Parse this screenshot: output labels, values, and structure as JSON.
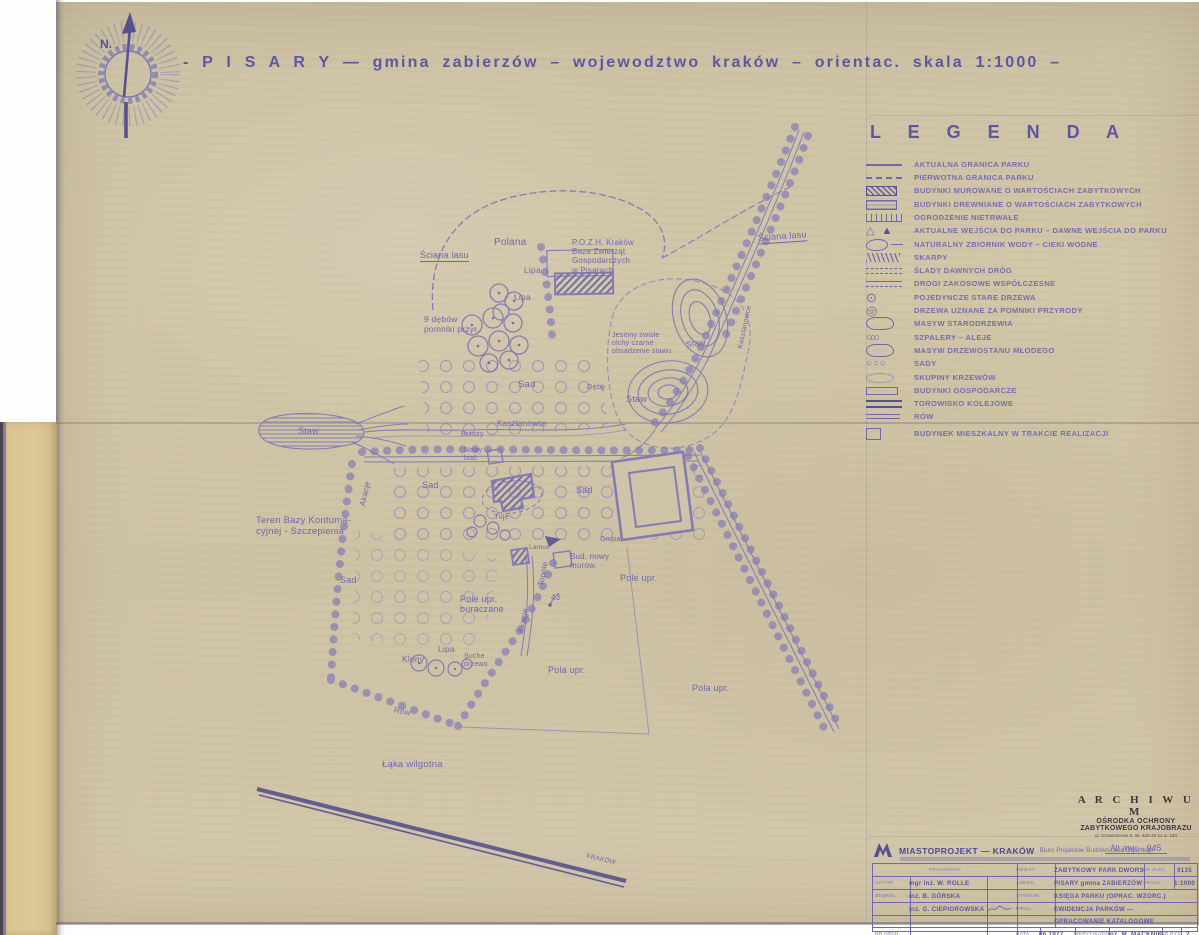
{
  "colors": {
    "ink": "#6f68ad",
    "ink_dark": "#57508f",
    "paper": "#d0c4a7",
    "side_strip": "#d9c592"
  },
  "title": {
    "text": "- P I S A R Y  —  gmina zabierzów – wojewodztwo  kraków – orientac.  skala    1:1000 –"
  },
  "compass": {
    "north_label": "N."
  },
  "legend": {
    "heading": "L E G E N D A",
    "items": [
      {
        "label": "AKTUALNA GRANICA PARKU"
      },
      {
        "label": "PIERWOTNA GRANICA PARKU"
      },
      {
        "label": "BUDYNKI MUROWANE O WARTOŚCIACH ZABYTKOWYCH"
      },
      {
        "label": "BUDYNKI DREWNIANE O WARTOŚCIACH ZABYTKOWYCH"
      },
      {
        "label": "OGRODZENIE NIETRWAŁE"
      },
      {
        "label": "AKTUALNE WEJŚCIA DO PARKU – DAWNE WEJŚCIA DO PARKU"
      },
      {
        "label": "NATURALNY ZBIORNIK WODY – CIEKI WODNE"
      },
      {
        "label": "SKARPY"
      },
      {
        "label": "ŚLADY DAWNYCH DRÓG"
      },
      {
        "label": "DROGI ZAKOSOWE WSPÓŁCZESNE"
      },
      {
        "label": "POJEDYNCZE STARE DRZEWA"
      },
      {
        "label": "DRZEWA UZNANE ZA POMNIKI PRZYRODY"
      },
      {
        "label": "MASYW STARODRZEWIA"
      },
      {
        "label": "SZPALERY – ALEJE"
      },
      {
        "label": "MASYW DRZEWOSTANU MŁODEGO"
      },
      {
        "label": "SADY"
      },
      {
        "label": "SKUPINY KRZEWÓW"
      },
      {
        "label": "BUDYNKI GOSPODARCZE"
      },
      {
        "label": "TOROWISKO KOLEJOWE"
      },
      {
        "label": "RÓW"
      },
      {
        "label": "BUDYNEK MIESZKALNY W TRAKCIE REALIZACJI"
      }
    ]
  },
  "map": {
    "labels": {
      "sciana_lasu": "Ściana lasu",
      "polana": "Polana",
      "pozh": "P.O.Z.H. Kraków\nBaza Zwierząt\nGospodarczych\nw Pisarach",
      "lipa": "Lipa",
      "deby_pomniki": "9 dębów\npomniki przyr.",
      "jesiony": "Jesiony zwisłe\nolchy czarne\nobsadzenie stawu",
      "staw": "Staw",
      "sad": "Sad",
      "kasztanowce": "Kasztanowce",
      "brzozy": "Brzozy",
      "nowy_bud": "Nowy\nbud.",
      "akacje": "Akacje",
      "teren_bazy": "Teren Bazy Kontuma-\ncyjnej - Szczepienia",
      "tuje": "Tuje",
      "grupa": "Grupa",
      "lamus": "Lamus",
      "deby": "Dęby",
      "bud_nowy_murow": "Bud. nowy\nmurow.",
      "pole_upr": "Pole upr.",
      "pola_upr": "Pola upr.",
      "topole": "Topole",
      "pole_buraczane": "Pole upr.\nburaczane",
      "nr_43": "43",
      "klony": "Klony",
      "suche_drzewo": "Suche\ndrzewo",
      "row": "Rów",
      "laka_wilgotna": "Łąka wilgotna",
      "krakow": "KRAKÓW"
    }
  },
  "stamp": {
    "line1": "A R C H I W U M",
    "line2": "OŚRODKA OCHRONY",
    "line3": "ZABYTKOWEGO KRAJOBRAZU",
    "line4": "ul. Szwoleżerów 9, tel. 628 48 41 w. 153",
    "inventory_no": "Nr inw. - 945"
  },
  "titleblock": {
    "firm": "MIASTOPROJEKT — KRAKÓW",
    "firm_sub": "Biuro Projektów Budownictwa Ogólnego",
    "pracownia_label": "PRACOWNIA",
    "podpis_label": "PODPIS",
    "autor_label": "AUTOR",
    "autor": "mgr inż. W. ROLLE",
    "zespol_label": "ZESPÓŁ",
    "name2": "inż. B. GÓRSKA",
    "name3": "inż. G. CIEPIOROWSKA",
    "obiekt_label": "OBIEKT",
    "obiekt": "ZABYTKOWY PARK DWORSKI",
    "nr_zlec_label": "NR ZLEC.",
    "nr_zlec": "9135",
    "adres_label": "ADRES",
    "adres": "PISARY gmina ZABIERZÓW",
    "skala_label": "SKALA",
    "skala": "1:1000",
    "stadium_label": "STADIUM",
    "stadium": "KSIĘGA PARKU (OPRAC. WZORC.)",
    "proj_label": "PROJ.",
    "proj_line1": "EWIDENCJA PARKÓW —",
    "proj_line2": "OPRACOWANIE KATALOGOWE",
    "nr_arch_label": "NR ARCH.",
    "data_label": "DATA",
    "data": "06.1977",
    "weryfikator_label": "WERYFIKATOR",
    "weryfikator": "inż. M. MACKNIK",
    "nr_rys_label": "NR RYS.",
    "nr_rys": "2"
  }
}
